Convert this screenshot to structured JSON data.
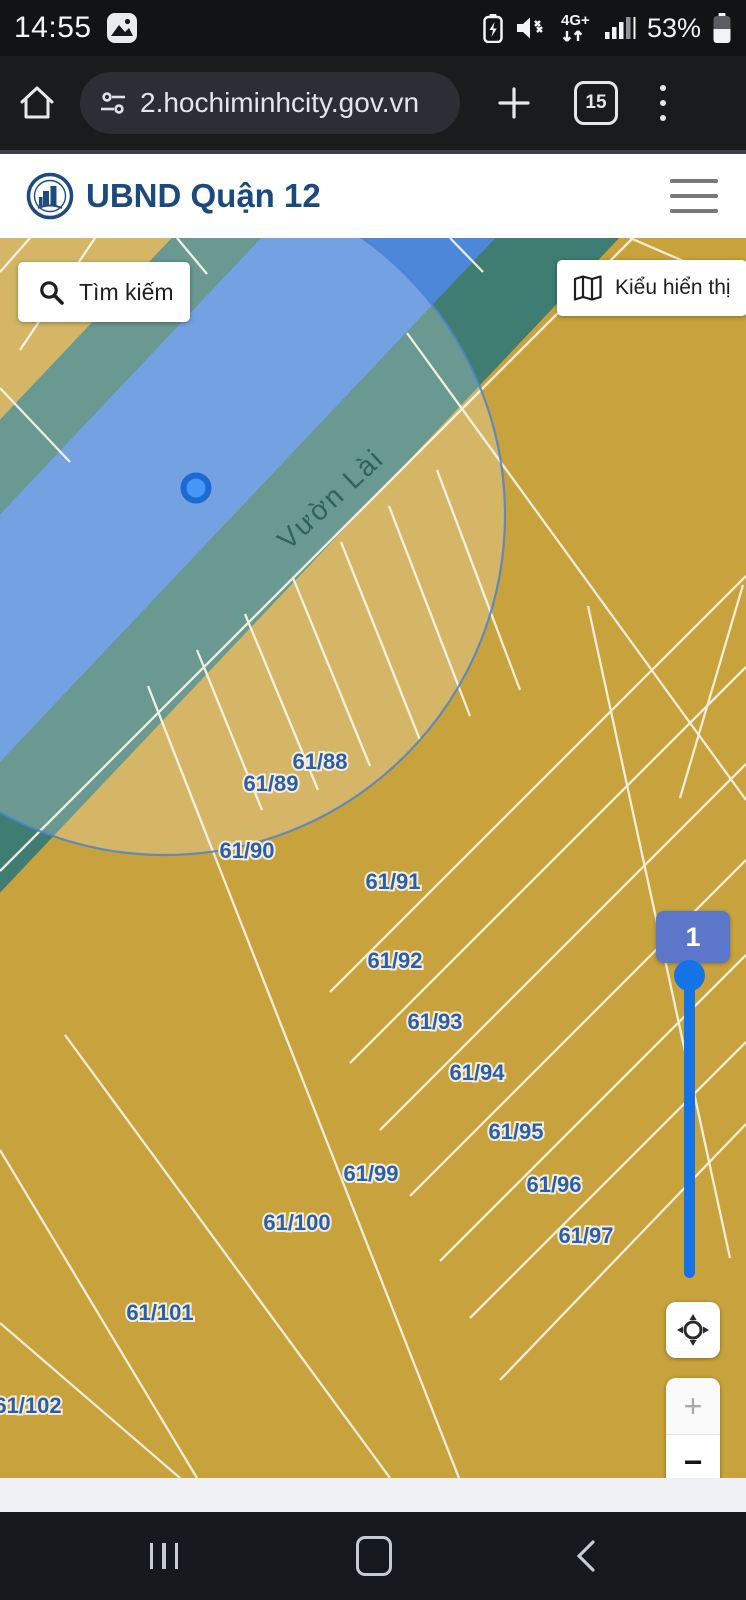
{
  "status_bar": {
    "time": "14:55",
    "battery_percent": "53%",
    "network_label": "4G+",
    "icons": [
      "gallery-icon",
      "battery-saver-icon",
      "volume-muted-icon",
      "network-4g-icon",
      "signal-strength-icon",
      "battery-icon"
    ]
  },
  "browser": {
    "url": "2.hochiminhcity.gov.vn",
    "tab_count": "15",
    "icons": [
      "home-icon",
      "site-settings-icon",
      "new-tab-icon",
      "tab-switcher-icon",
      "overflow-menu-icon"
    ]
  },
  "site_header": {
    "title": "UBND Quận 12",
    "logo": "ubnd-emblem",
    "menu_icon": "hamburger-icon"
  },
  "map": {
    "search_button_label": "Tìm kiếm",
    "display_button_label": "Kiểu hiển thị",
    "street_name": "Vườn Lài",
    "zoom_slider_value": "1",
    "zoom_in_label": "+",
    "zoom_out_label": "−",
    "parcels": [
      {
        "label": "61/88",
        "x": 320,
        "y": 531
      },
      {
        "label": "61/89",
        "x": 271,
        "y": 553
      },
      {
        "label": "61/90",
        "x": 247,
        "y": 620
      },
      {
        "label": "61/91",
        "x": 393,
        "y": 651
      },
      {
        "label": "61/92",
        "x": 395,
        "y": 730
      },
      {
        "label": "61/93",
        "x": 435,
        "y": 791
      },
      {
        "label": "61/94",
        "x": 477,
        "y": 842
      },
      {
        "label": "61/95",
        "x": 516,
        "y": 901
      },
      {
        "label": "61/96",
        "x": 554,
        "y": 954
      },
      {
        "label": "61/97",
        "x": 586,
        "y": 1005
      },
      {
        "label": "61/99",
        "x": 371,
        "y": 943
      },
      {
        "label": "61/100",
        "x": 297,
        "y": 992
      },
      {
        "label": "61/101",
        "x": 160,
        "y": 1082
      },
      {
        "label": "61/102",
        "x": 28,
        "y": 1175
      }
    ],
    "colors": {
      "parcel_fill": "#C8A23C",
      "corridor_teal": "#3F7D72",
      "road_blue": "#4C87D9",
      "selection_circle_stroke": "#4D82CC",
      "parcel_line": "#F6F1E0",
      "parcel_label": "#2B5DA8",
      "slider_accent": "#1673E6",
      "badge_fill": "#5C76C9"
    }
  },
  "android_nav": {
    "icons": [
      "recents-icon",
      "home-pill-icon",
      "back-icon"
    ]
  }
}
